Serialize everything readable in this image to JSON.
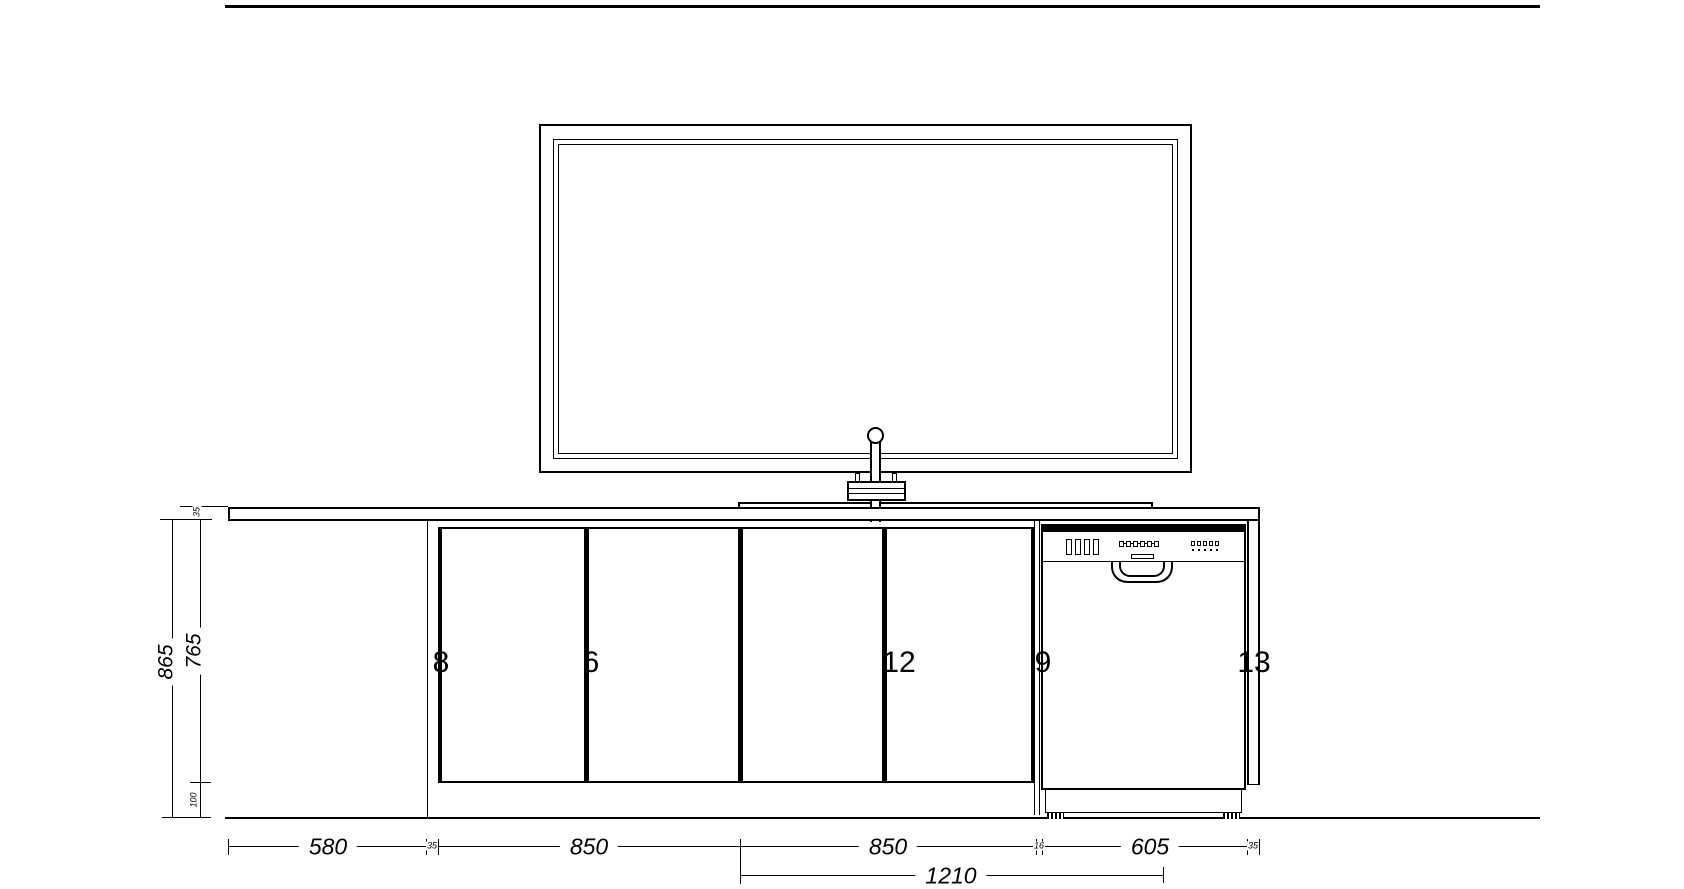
{
  "title": "kitchen-elevation-drawing",
  "dimensions": {
    "vertical": {
      "worktop_thickness": "35",
      "carcass_height": "765",
      "counter_height": "865",
      "plinth_height": "100"
    },
    "horizontal": {
      "segments": [
        "580",
        "35",
        "850",
        "850",
        "16",
        "605",
        "35"
      ],
      "overall": "1210"
    }
  },
  "cabinets": {
    "labels": [
      "8",
      "6",
      "12",
      "9",
      "13"
    ]
  },
  "colors": {
    "line": "#000000",
    "background": "#ffffff"
  }
}
